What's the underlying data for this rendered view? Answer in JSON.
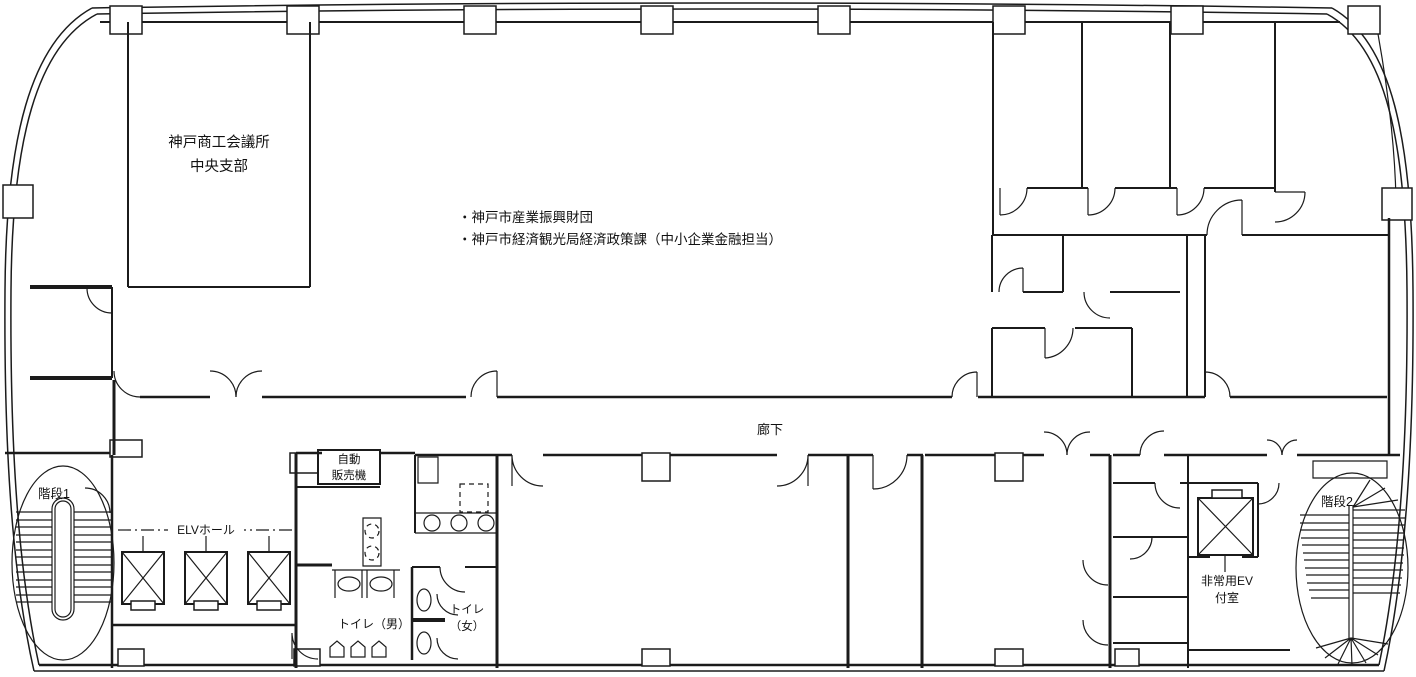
{
  "colors": {
    "line": "#1b1b1b",
    "background": "#ffffff"
  },
  "labels": {
    "kcci_line1": "神戸商工会議所",
    "kcci_line2": "中央支部",
    "tenants": [
      "・神戸市産業振興財団",
      "・神戸市経済観光局経済政策課（中小企業金融担当）"
    ],
    "corridor": "廊下",
    "vending_line1": "自動",
    "vending_line2": "販売機",
    "elv_hall": "ELVホール",
    "toilet_men": "トイレ（男）",
    "toilet_women_line1": "トイレ",
    "toilet_women_line2": "（女）",
    "stairs1": "階段1",
    "stairs2": "階段2",
    "emergency_ev_line1": "非常用EV",
    "emergency_ev_line2": "付室"
  }
}
